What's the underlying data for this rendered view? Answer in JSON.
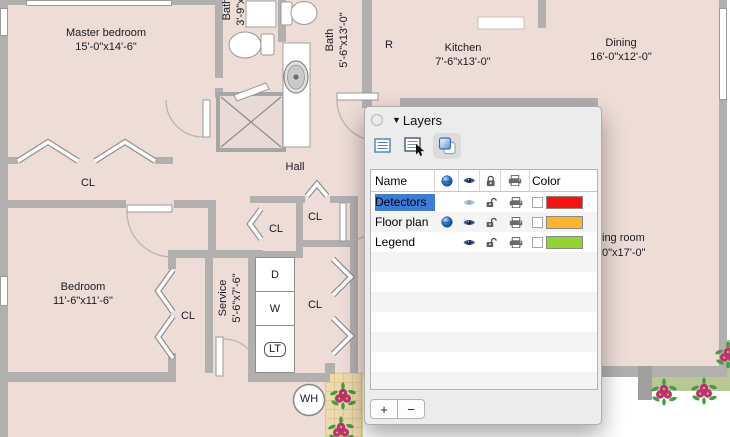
{
  "floor_plan": {
    "master_bedroom": {
      "name": "Master bedroom",
      "dims": "15'-0\"x14'-6\""
    },
    "bath_small": {
      "name": "Bath",
      "dims": "3'-9\"x1"
    },
    "bath_main": {
      "name": "Bath",
      "dims": "5'-6\"x13'-0\""
    },
    "kitchen": {
      "name": "Kitchen",
      "dims": "7'-6\"x13'-0\""
    },
    "dining": {
      "name": "Dining",
      "dims": "16'-0\"x12'-0\""
    },
    "bedroom": {
      "name": "Bedroom",
      "dims": "11'-6\"x11'-6\""
    },
    "service": {
      "name": "Service",
      "dims": "5'-6\"x7'-6\""
    },
    "living_room_partial": {
      "name_fragment": "ing room",
      "dims_fragment": "0\"x17'-0\""
    },
    "hall_label": "Hall",
    "closet_label": "CL",
    "refrigerator_label": "R",
    "dryer_label": "D",
    "washer_label": "W",
    "laundry_tub_label": "LT",
    "water_heater_label": "WH"
  },
  "layers_panel": {
    "title": "Layers",
    "disclosure_icon": "▼",
    "toolbar": {
      "buttons": [
        {
          "name": "list-view",
          "selected": false
        },
        {
          "name": "list-view-edit",
          "selected": false
        },
        {
          "name": "layers-view",
          "selected": true
        }
      ]
    },
    "table": {
      "name_header": "Name",
      "color_header": "Color",
      "icon_columns": [
        "active-layer",
        "visibility",
        "lock",
        "print"
      ],
      "rows": [
        {
          "name": "Detectors",
          "selected": true,
          "active": false,
          "visible": true,
          "visible_dimmed": true,
          "locked": false,
          "printable": true,
          "color": "#fb100d"
        },
        {
          "name": "Floor plan",
          "selected": false,
          "active": true,
          "visible": true,
          "visible_dimmed": false,
          "locked": false,
          "printable": true,
          "color": "#fcb42c"
        },
        {
          "name": "Legend",
          "selected": false,
          "active": false,
          "visible": true,
          "visible_dimmed": false,
          "locked": false,
          "printable": true,
          "color": "#90d432"
        }
      ],
      "empty_row_count": 7
    },
    "add_button": "+",
    "remove_button": "−"
  },
  "palette": {
    "room_fill": "#eedcd7",
    "wall": "#b2afaf",
    "selection_blue": "#3d7bd9",
    "garden_green": "#b9c795",
    "tile_tan": "#ecd9ad",
    "rose": "#bc3273"
  }
}
